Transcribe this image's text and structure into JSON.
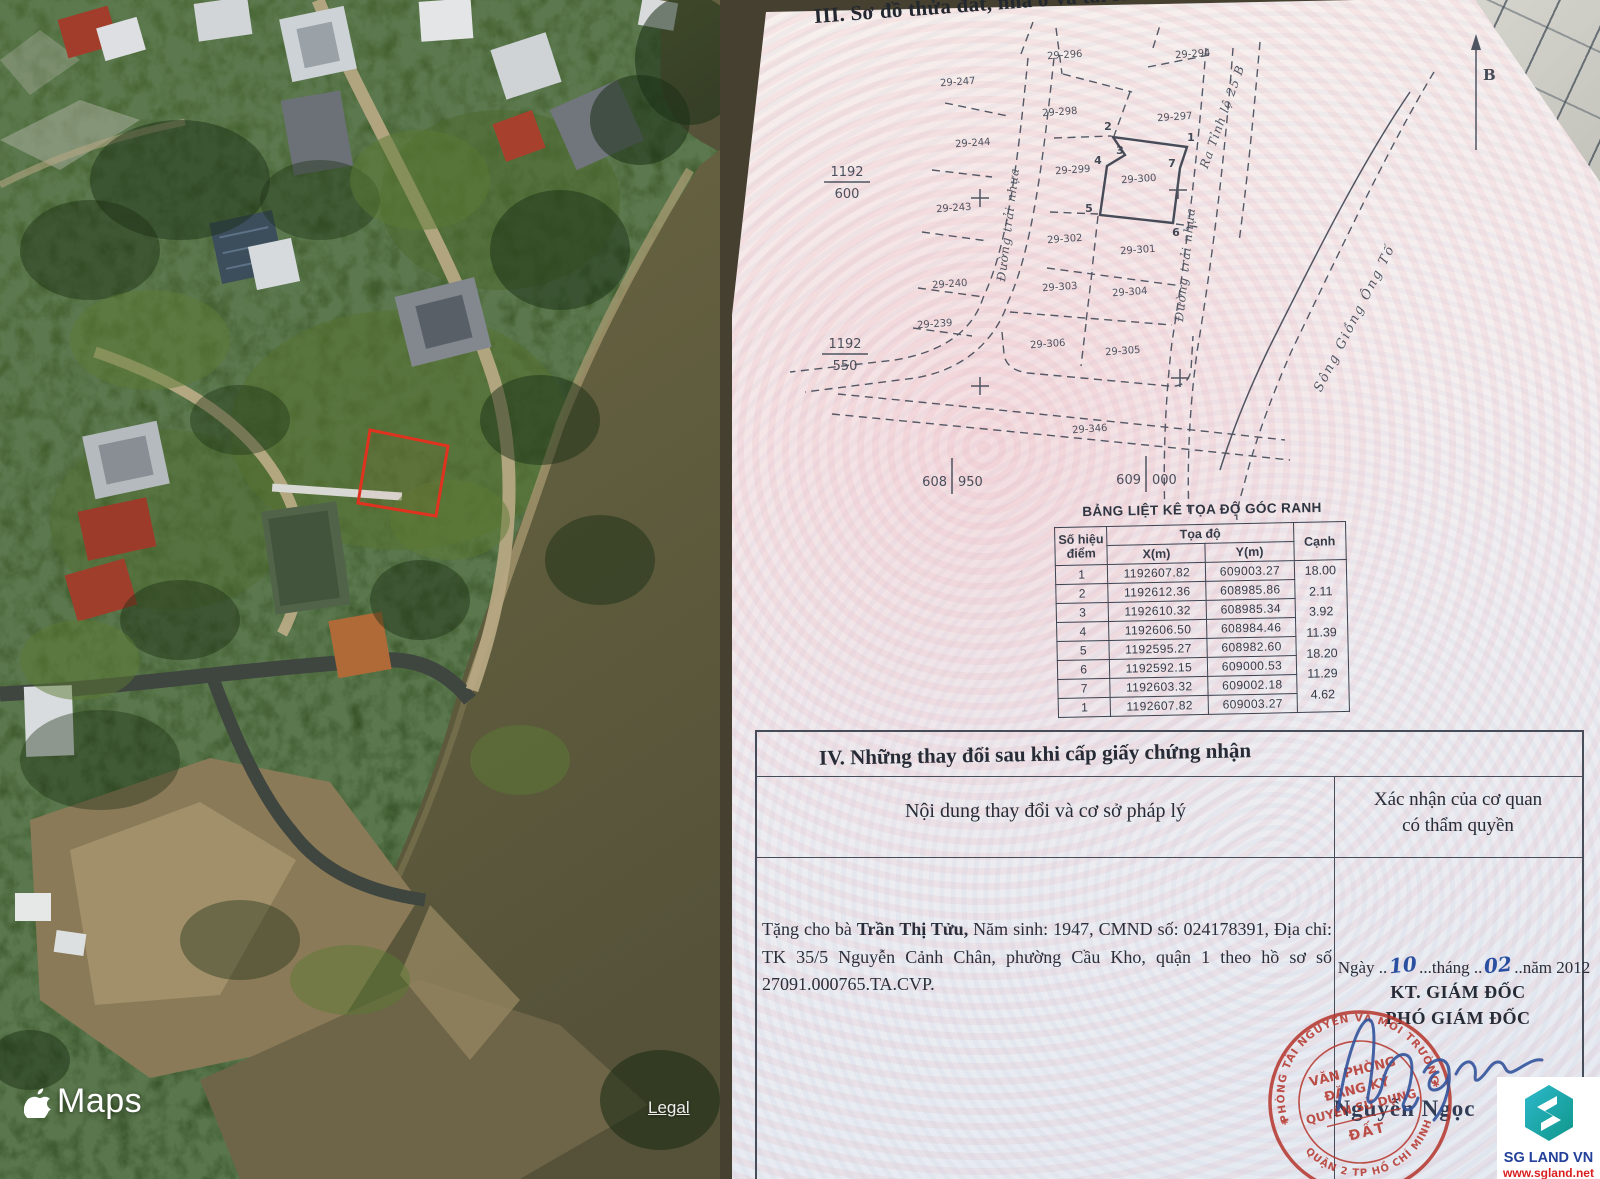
{
  "map": {
    "brand": "Maps",
    "legal_label": "Legal",
    "parcel_outline_color": "#e0321f"
  },
  "document": {
    "section3_title": "III. Sơ đồ thửa đất, nhà ở và tài sản khác gắn liền với đất",
    "diagram": {
      "north_label": "B",
      "parcels": [
        "29-247",
        "29-296",
        "29-294",
        "29-298",
        "29-297",
        "29-244",
        "29-299",
        "29-300",
        "29-243",
        "29-302",
        "29-301",
        "29-240",
        "29-303",
        "29-304",
        "29-239",
        "29-306",
        "29-305",
        "29-346"
      ],
      "vertices": [
        "1",
        "2",
        "3",
        "4",
        "5",
        "6",
        "7"
      ],
      "road_left": "Đường trải nhựa",
      "road_right": "Đường trải nhựa",
      "road_exit": "Ra Tỉnh lộ 25 B",
      "river": "Sông Giồng Ông Tố",
      "grid": {
        "f1n": "1192",
        "f1d": "600",
        "f2n": "1192",
        "f2d": "550",
        "h1a": "608",
        "h1b": "950",
        "h2a": "609",
        "h2b": "000"
      }
    },
    "coord_table": {
      "title": "BẢNG LIỆT KÊ TỌA ĐỘ GÓC RANH",
      "col_point_1": "Số hiệu",
      "col_point_2": "điểm",
      "col_coord": "Tọa độ",
      "col_x": "X(m)",
      "col_y": "Y(m)",
      "col_edge": "Cạnh",
      "points": [
        {
          "id": "1",
          "x": "1192607.82",
          "y": "609003.27"
        },
        {
          "id": "2",
          "x": "1192612.36",
          "y": "608985.86"
        },
        {
          "id": "3",
          "x": "1192610.32",
          "y": "608985.34"
        },
        {
          "id": "4",
          "x": "1192606.50",
          "y": "608984.46"
        },
        {
          "id": "5",
          "x": "1192595.27",
          "y": "608982.60"
        },
        {
          "id": "6",
          "x": "1192592.15",
          "y": "609000.53"
        },
        {
          "id": "7",
          "x": "1192603.32",
          "y": "609002.18"
        },
        {
          "id": "1",
          "x": "1192607.82",
          "y": "609003.27"
        }
      ],
      "edges": [
        "18.00",
        "2.11",
        "3.92",
        "11.39",
        "18.20",
        "11.29",
        "4.62"
      ]
    },
    "section4": {
      "title": "IV. Những thay đổi sau khi cấp giấy chứng nhận",
      "col_left": "Nội dung thay đổi và cơ sở pháp lý",
      "col_right_1": "Xác nhận của cơ quan",
      "col_right_2": "có thẩm quyền",
      "entry_prefix": "Tặng cho bà ",
      "entry_name": "Trần Thị Tửu,",
      "entry_rest": " Năm sinh: 1947, CMND số: 024178391, Địa chỉ: TK 35/5 Nguyễn Cảnh Chân, phường Cầu Kho, quận 1 theo hồ sơ số 27091.000765.TA.CVP.",
      "date_p1": "Ngày ..",
      "date_day": "10",
      "date_p2": "...tháng ..",
      "date_month": "02",
      "date_p3": "..năm 2012",
      "kt_line": "KT. GIÁM ĐỐC",
      "pho_line": "PHÓ GIÁM ĐỐC",
      "signer": "Nguyễn Ngọc",
      "stamp": {
        "ring_top": "PHÒNG TÀI NGUYÊN VÀ MÔI TRƯỜNG",
        "ring_bottom": "QUẬN 2 TP HỒ CHÍ MINH",
        "line1": "VĂN PHÒNG",
        "line2": "ĐĂNG KÝ",
        "line3": "QUYỀN SỬ DỤNG",
        "line4": "ĐẤT"
      }
    },
    "logo": {
      "name": "SG LAND VN",
      "site": "www.sgland.net"
    }
  }
}
